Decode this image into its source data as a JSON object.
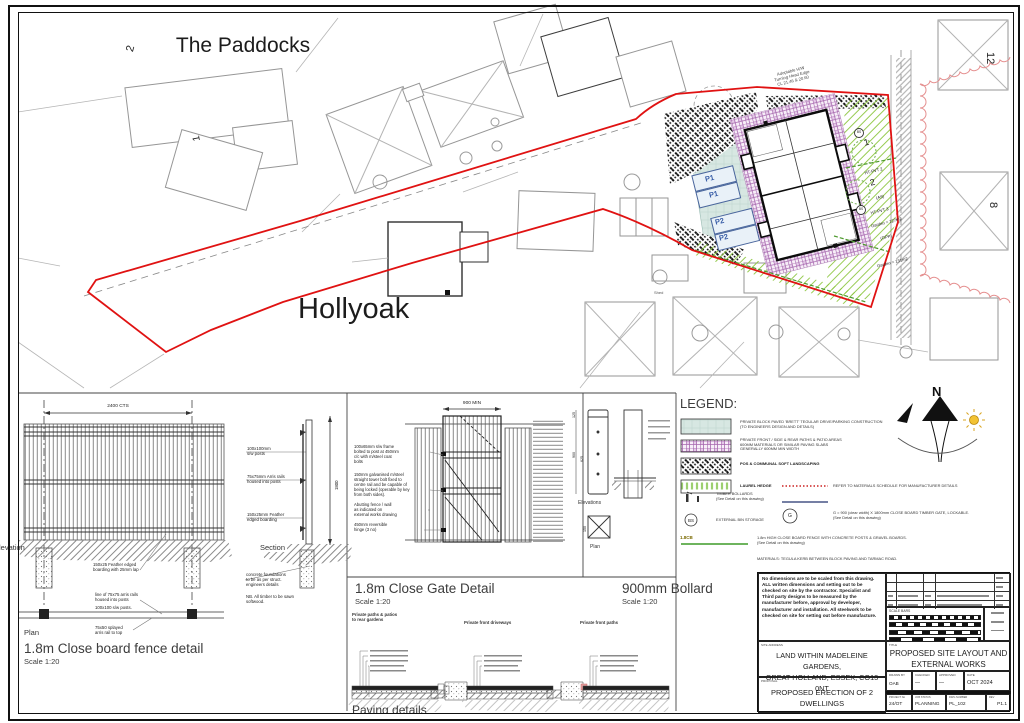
{
  "plan": {
    "paddocks": "The Paddocks",
    "hollyoak": "Hollyoak",
    "shed": "Shed",
    "adoptable": "Adoptable H/W\nTurning Head Edge\nCL 21.46 & 20.60",
    "num2": "2",
    "num1": "1",
    "num12": "12",
    "num8": "8",
    "parking": [
      "P1",
      "P1",
      "P2",
      "P2"
    ],
    "plot1": {
      "num": "1",
      "type": "HT-PVT 2",
      "variant": "(AS)",
      "garden": "Garden = 127m2"
    },
    "plot2": {
      "num": "2",
      "type": "HT-PVT 3",
      "variant": "(OPP)",
      "garden": "Garden = 131m2"
    },
    "bs": "BS"
  },
  "legend": {
    "title": "LEGEND:",
    "bs": "BS",
    "g": "G",
    "cb": "1.8CB",
    "entries": [
      "PRIVATE BLOCK PAVED 'BRETT' TEGULAR DRIVE/PARKING CONSTRUCTION\n(TO ENGINEERS DESIGN AND DETAILS)",
      "PRIVATE FRONT / SIDE & REAR PATHS & PATIO AREAS\n600MM MATERIALS OR SIMILAR PAVING SLABS\nGENERALLY 600MM MIN WIDTH",
      "POS & COMMUNAL SOFT LANDSCAPING",
      "LAUREL HEDGE",
      "REFER TO MATERIALS SCHEDULE FOR MANUFACTURER DETAILS",
      "TIMBER BOLLARDS\n(See Detail on this drawing)",
      "EXTERNAL BIN STORAGE",
      "G = 900 (clear width) X 1800mm CLOSE BOARD TIMBER GATE, LOCKABLE.\n(See Detail on this drawing)",
      "1.8m HIGH CLOSE BOARD FENCE WITH CONCRETE POSTS & GRAVEL BOARDS.\n(See Detail on this drawing)",
      "MATERIALS: TEGULA KERB BETWEEN BLOCK PAVING AND TARMAC ROAD."
    ]
  },
  "north": {
    "n": "N"
  },
  "fence": {
    "title": "1.8m Close board fence detail",
    "scale": "Scale 1:20",
    "dim": "2400 CTS",
    "dim_height": "1800",
    "posts": "100x100mm\ns/w posts",
    "arris": "75x75mm Arris rails\nhoused into posts",
    "feather": "150x25mm Feather\nedged boarding",
    "feather2": "150x25 Feather edged\nboarding with 25mm lap",
    "line75": "line of 75x75 arris rails\nhoused into posts",
    "posts2": "100x100 s/w posts.",
    "splayed": "75x50 splayed\narris rail to top",
    "concrete": "concrete foundations\nto be as per struct.\nengineers details",
    "nb": "NB. All timber to be sawn\nsoftwood.",
    "section": "Section",
    "elevation": "Elevation",
    "plan": "Plan"
  },
  "gate": {
    "title": "1.8m Close Gate Detail",
    "scale": "Scale 1:20",
    "dim": "900 MIN",
    "frame": "100x65mm s/w frame\nbolted to post at 450mm\nc/c with m/steel coat\nbolts",
    "bolt": "150mm galvanised m/steel\nstraight tower bolt fixed to\ncentre rail and be capable of\nbeing locked (operable by key\nfrom both sides).",
    "abutting": "Abutting fence / wall\nas indicated on\nexternal works drawing",
    "hinge": "450mm reversible\nhinge (3 no)"
  },
  "bollard": {
    "title": "900mm Bollard",
    "scale": "Scale 1:20",
    "d125": "125",
    "d625": "625",
    "d900": "900",
    "d150": "150",
    "elevations": "Elevations",
    "plan": "Plan"
  },
  "paving": {
    "title": "Paving details",
    "captions": [
      "Private paths & patios\nto rear gardens",
      "Private front driveways",
      "Private front paths"
    ]
  },
  "titleblock": {
    "notes": "No dimensions are to be scaled from this drawing. ALL written dimensions and setting out to be checked on site by the contractor. Specialist and Third party designs to be measured by the manufacturer before, approval by developer, manufacturer and installation. All steelwork to be checked on site for setting out before manufacture.",
    "scale_bars": "SCALE BARS",
    "site_address_label": "SITE ADDRESS",
    "site_address": "LAND WITHIN MADELEINE GARDENS,\nGREAT HOLLAND, ESSEX, CO13 0NT",
    "proposal_label": "PROPOSAL",
    "proposal": "PROPOSED ERECTION OF 2\nDWELLINGS",
    "title_label": "TITLE",
    "title": "PROPOSED SITE LAYOUT AND\nEXTERNAL WORKS",
    "drawn_label": "DRAWN BY",
    "drawn": "OAB",
    "checked_label": "CHECKED",
    "checked": "—",
    "approved_label": "APPROVED",
    "approved": "—",
    "date_label": "DATE",
    "date": "OCT 2024",
    "project_label": "PROJECT No",
    "project": "24/OT",
    "status_label": "JOB STATUS",
    "status": "PLANNING",
    "dwg_label": "DWG NUMBER",
    "dwg": "PL_102",
    "rev_label": "REV",
    "rev": "P1.1"
  }
}
